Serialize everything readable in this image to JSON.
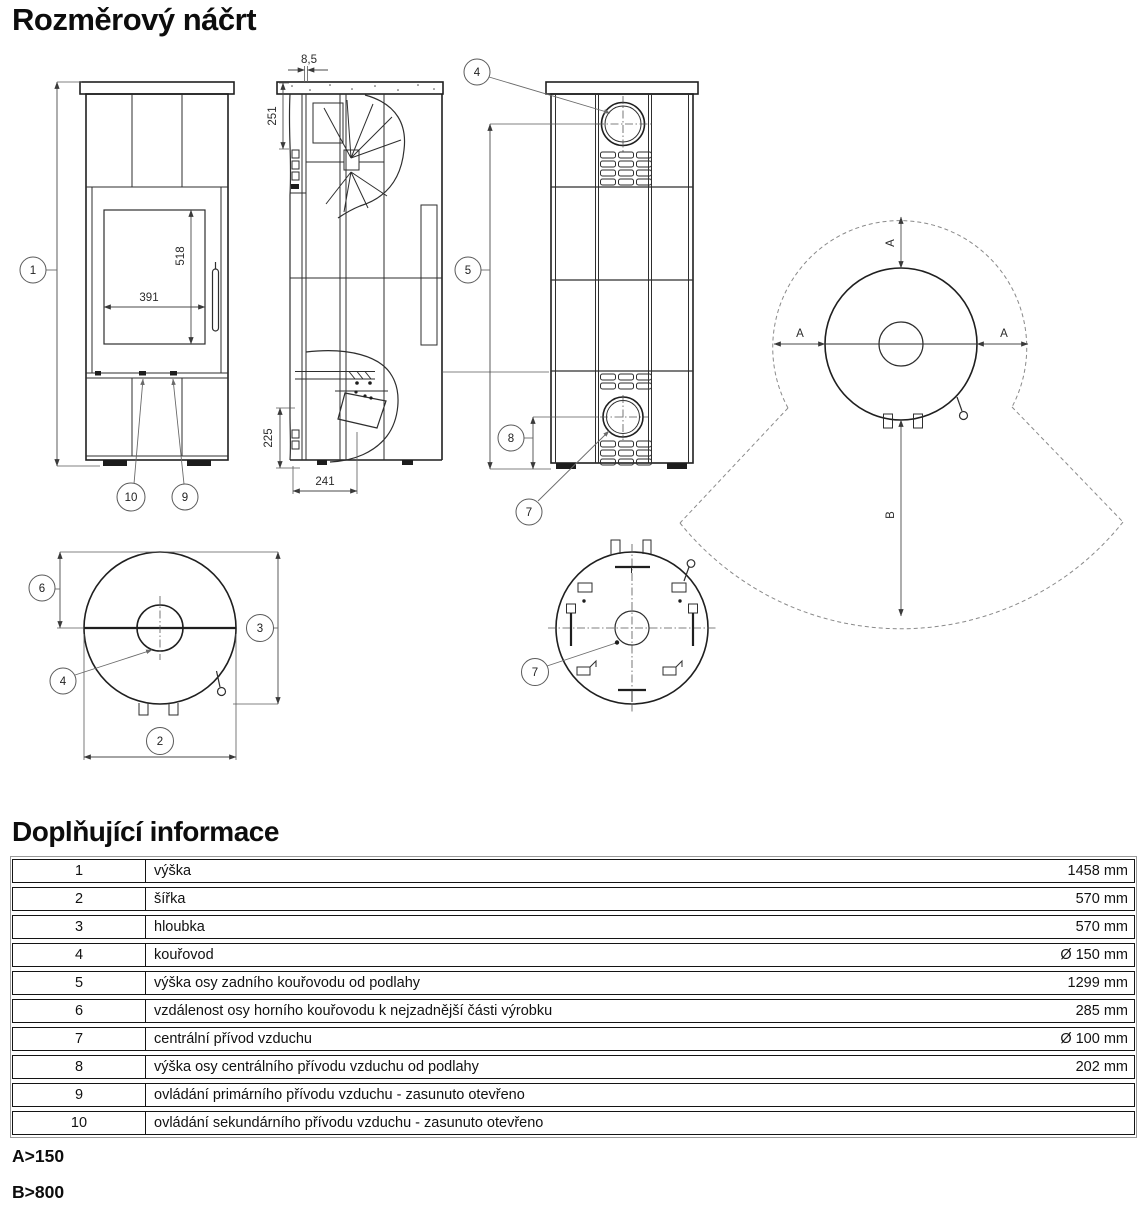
{
  "page": {
    "title": "Rozměrový náčrt",
    "info_title": "Doplňující informace",
    "note_a": "A>150",
    "note_b": "B>800"
  },
  "drawing": {
    "front": {
      "callout_height": "1",
      "callout_primary_air": "10",
      "callout_secondary_air": "9",
      "glass_width": "391",
      "glass_height": "518"
    },
    "side": {
      "gap": "8,5",
      "top_section": "251",
      "bottom_section": "225",
      "depth": "241"
    },
    "back": {
      "callout_flue": "4",
      "callout_flue_axis_height": "5",
      "callout_air_axis_height": "8",
      "callout_central_air": "7"
    },
    "top": {
      "callout_rear_distance": "6",
      "callout_depth": "3",
      "callout_width": "2",
      "callout_flue": "4"
    },
    "bottom": {
      "callout_central_air": "7"
    },
    "clearance": {
      "label_a": "A",
      "label_b": "B"
    }
  },
  "table": {
    "rows": [
      {
        "num": "1",
        "label": "výška",
        "value": "1458 mm"
      },
      {
        "num": "2",
        "label": "šířka",
        "value": "570 mm"
      },
      {
        "num": "3",
        "label": "hloubka",
        "value": "570 mm"
      },
      {
        "num": "4",
        "label": "kouřovod",
        "value": "Ø 150 mm"
      },
      {
        "num": "5",
        "label": "výška osy zadního kouřovodu od podlahy",
        "value": "1299 mm"
      },
      {
        "num": "6",
        "label": "vzdálenost osy horního kouřovodu k nejzadnější části výrobku",
        "value": "285 mm"
      },
      {
        "num": "7",
        "label": "centrální přívod vzduchu",
        "value": "Ø 100 mm"
      },
      {
        "num": "8",
        "label": "výška osy centrálního přívodu vzduchu od podlahy",
        "value": "202 mm"
      },
      {
        "num": "9",
        "label": "ovládání primárního přívodu vzduchu - zasunuto otevřeno",
        "value": ""
      },
      {
        "num": "10",
        "label": "ovládání sekundárního přívodu vzduchu - zasunuto otevřeno",
        "value": ""
      }
    ]
  }
}
